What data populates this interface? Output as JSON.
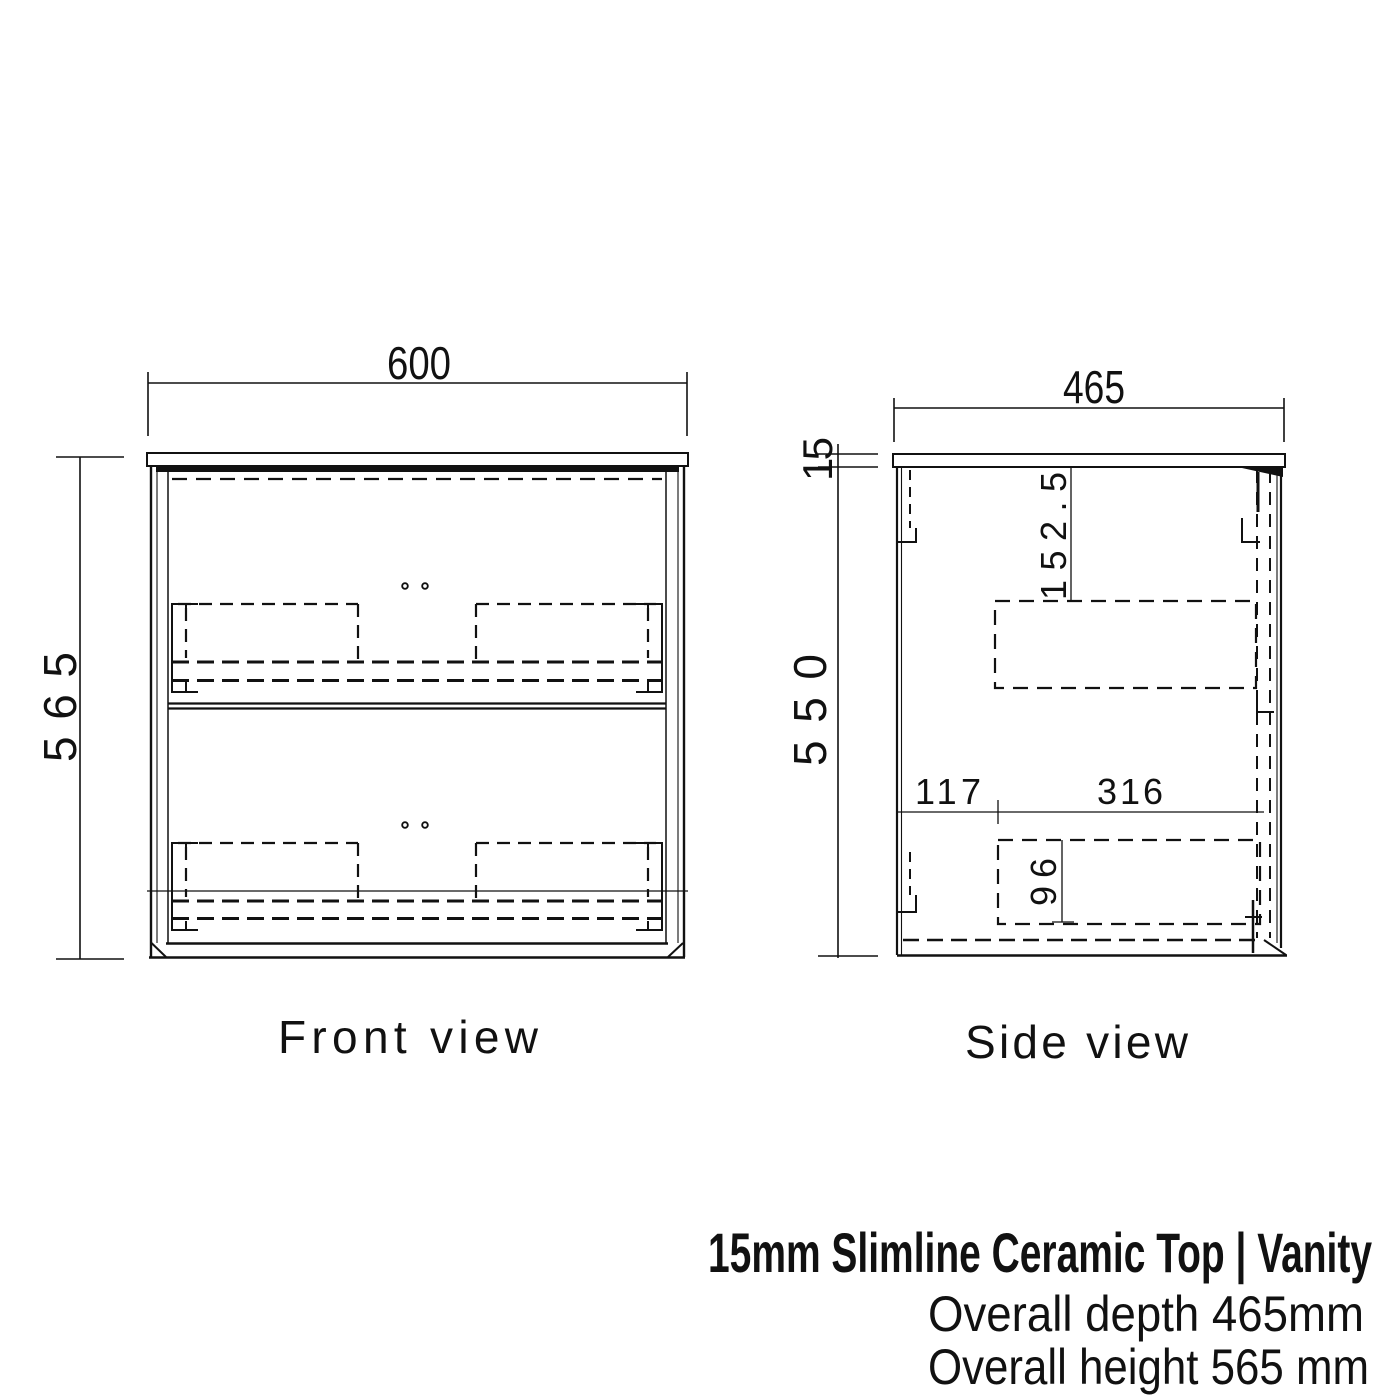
{
  "drawing": {
    "front": {
      "label": "Front view",
      "width_mm": "600",
      "height_mm": "565"
    },
    "side": {
      "label": "Side view",
      "depth_mm": "465",
      "top_thickness_mm": "15",
      "carcass_height_mm": "550",
      "runner_top_offset_mm": "152.5",
      "runner_front_offset_mm": "117",
      "runner_length_mm": "316",
      "runner_height_mm": "96"
    },
    "title_block": {
      "product_title": "15mm Slimline Ceramic Top | Vanity",
      "specs": [
        {
          "text": "Overall depth  465mm"
        },
        {
          "text": "Overall height  565 mm"
        }
      ]
    },
    "line_color": "#111111",
    "background_color": "#ffffff"
  }
}
